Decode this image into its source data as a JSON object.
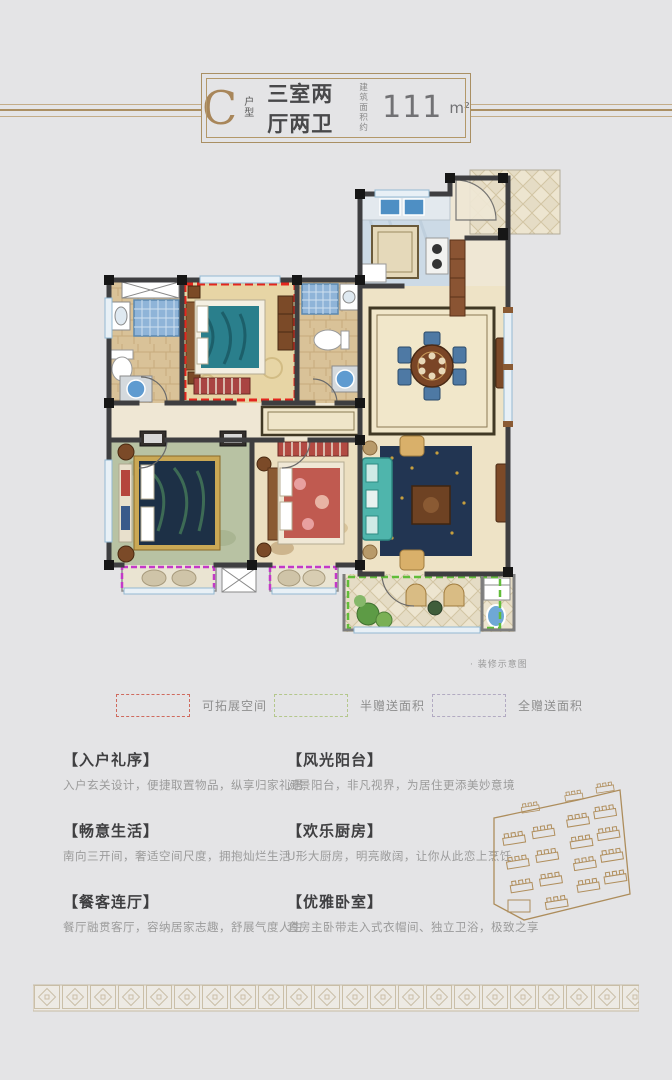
{
  "header": {
    "type_letter": "C",
    "type_label": "户型",
    "title": "三室两厅两卫",
    "area_prefix_line1": "建筑",
    "area_prefix_line2": "面积约",
    "area_value": "111",
    "area_unit": "m²"
  },
  "floorplan": {
    "caption": "· 装修示意图",
    "overlay_colors": {
      "expandable_space": "#e3261d",
      "half_gift_area": "#62bd3a",
      "full_gift_area": "#c438c8"
    }
  },
  "legend": {
    "items": [
      {
        "label": "可拓展空间",
        "swatch_color": "#cf6a5e"
      },
      {
        "label": "半赠送面积",
        "swatch_color": "#b4c78c"
      },
      {
        "label": "全赠送面积",
        "swatch_color": "#b2aac2"
      }
    ]
  },
  "features": [
    {
      "title": "【入户礼序】",
      "desc": "入户玄关设计，便捷取置物品，纵享归家礼遇"
    },
    {
      "title": "【风光阳台】",
      "desc": "阅景阳台，非凡视界，为居住更添美妙意境"
    },
    {
      "title": "【畅意生活】",
      "desc": "南向三开间，奢适空间尺度，拥抱灿烂生活"
    },
    {
      "title": "【欢乐厨房】",
      "desc": "U形大厨房，明亮敞阔，让你从此恋上烹饪"
    },
    {
      "title": "【餐客连厅】",
      "desc": "餐厅融贯客厅，容纳居家志趣，舒展气度人生"
    },
    {
      "title": "【优雅卧室】",
      "desc": "套房主卧带走入式衣帽间、独立卫浴，极致之享"
    }
  ],
  "colors": {
    "accent_gold": "#ab8f63",
    "page_background": "#e4e4e6"
  }
}
